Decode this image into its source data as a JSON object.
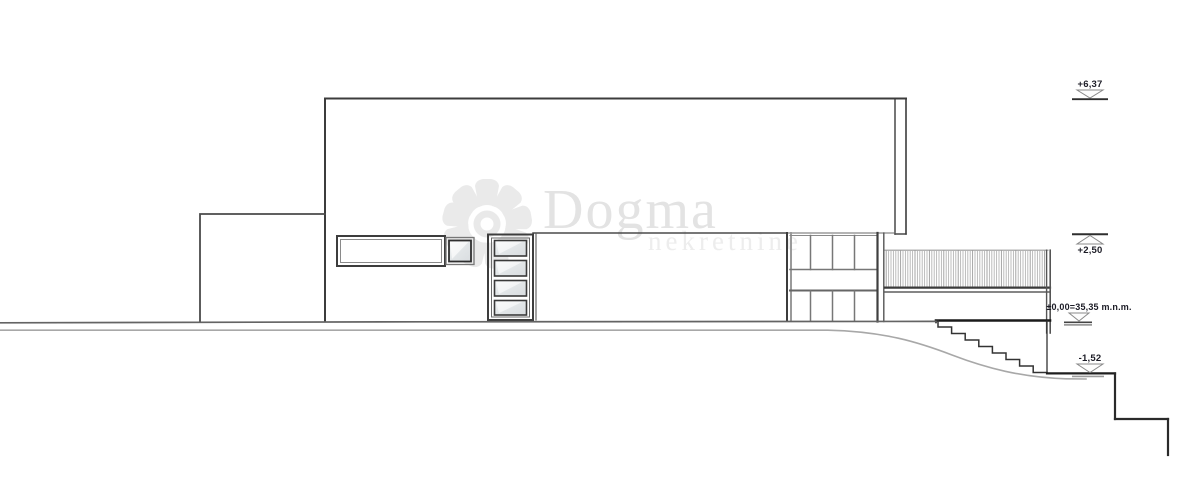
{
  "watermark": {
    "brand": "Dogma",
    "subtitle": "nekretnine"
  },
  "levels": [
    {
      "id": "roof",
      "label": "+6,37"
    },
    {
      "id": "terrace",
      "label": "+2,50"
    },
    {
      "id": "ground",
      "label": "±0,00=35,35 m.n.m."
    },
    {
      "id": "basement",
      "label": "-1,52"
    }
  ],
  "colors": {
    "line_dark": "#3c3c3c",
    "line_bold": "#1e1e1e",
    "line_gray": "#8a8a8a",
    "terrain_dark": "#646464",
    "terrain_light": "#a8a8a8",
    "glass": "#e3e7e9",
    "watermark": "#eaeaea",
    "label_text": "#1c1c26"
  }
}
